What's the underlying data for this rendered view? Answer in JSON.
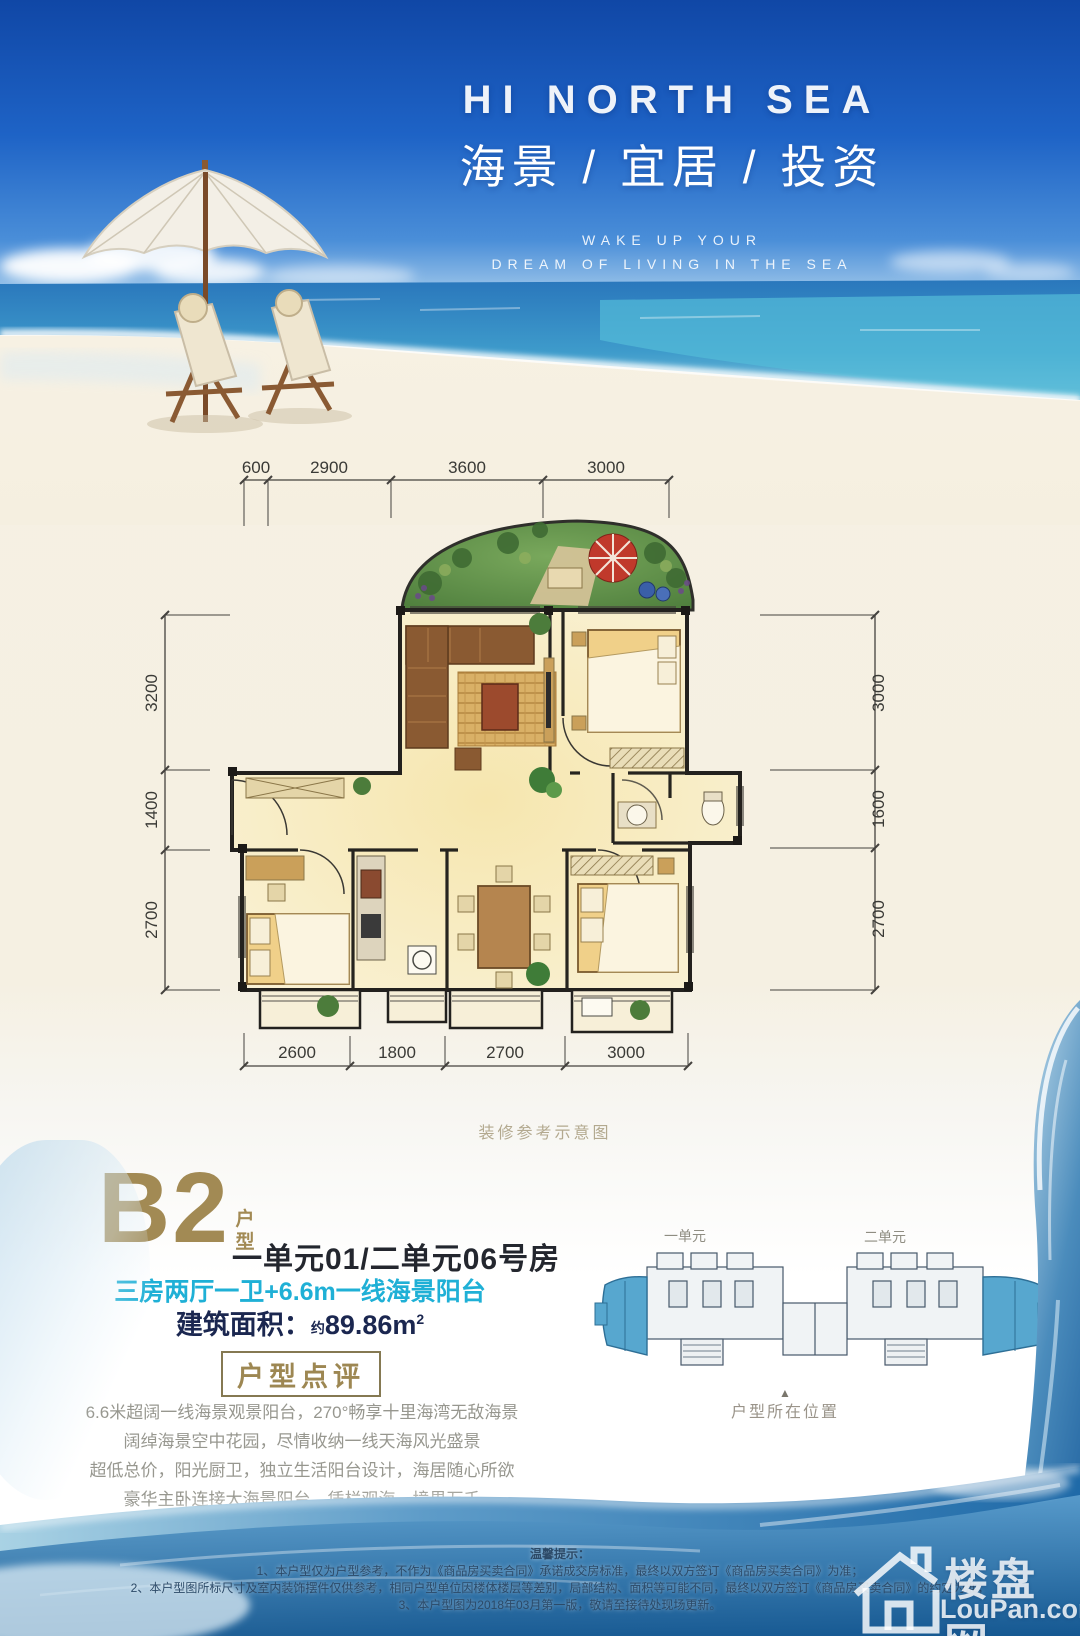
{
  "header": {
    "title_en": "HI NORTH SEA",
    "title_cn": "海景 / 宜居 / 投资",
    "tagline_line1": "WAKE UP YOUR",
    "tagline_line2": "DREAM OF LIVING IN THE SEA"
  },
  "floor_plan": {
    "caption": "装修参考示意图",
    "dimensions": {
      "top": [
        "600",
        "2900",
        "3600",
        "3000"
      ],
      "bottom": [
        "2600",
        "1800",
        "2700",
        "3000"
      ],
      "left": [
        "3200",
        "1400",
        "2700"
      ],
      "right": [
        "3000",
        "1600",
        "2700"
      ]
    }
  },
  "unit_info": {
    "code": "B2",
    "code_label_1": "户",
    "code_label_2": "型",
    "room_no": "一单元01/二单元06号房",
    "features": "三房两厅一卫+6.6m一线海景阳台",
    "area_label": "建筑面积：",
    "area_prefix": "约",
    "area_value": "89.86m",
    "area_exp": "2",
    "review_title": "户型点评",
    "review_lines": [
      "6.6米超阔一线海景观景阳台，270°畅享十里海湾无敌海景",
      "阔绰海景空中花园，尽情收纳一线天海风光盛景",
      "超低总价，阳光厨卫，独立生活阳台设计，海居随心所欲",
      "豪华主卧连接大海景阳台，凭栏观海，境界万千"
    ]
  },
  "key_plan": {
    "unit1_label": "一单元",
    "unit2_label": "二单元",
    "marker": "▲",
    "location_label": "户型所在位置",
    "highlight_color": "#57a7cf"
  },
  "footer": {
    "notice_title": "温馨提示：",
    "notices": [
      "1、本户型仅为户型参考，不作为《商品房买卖合同》承诺成交房标准，最终以双方签订《商品房买卖合同》为准；",
      "2、本户型图所标尺寸及室内装饰摆件仅供参考，相同户型单位因楼体楼层等差别，局部结构、面积等可能不同，最终以双方签订《商品房买卖合同》的约定为准；",
      "3、本户型图为2018年03月第一版，敬请至接待处现场更新。"
    ],
    "watermark_cn": "楼盘网",
    "watermark_en": "LouPan.com"
  },
  "colors": {
    "gold": "#a28a54",
    "cyan": "#1fb0d6",
    "navy": "#1b2750",
    "sky_deep": "#1450ae",
    "sea_turquoise": "#54bcd8",
    "sand": "#f5efe0",
    "wave_deep": "#1f6aa8"
  }
}
